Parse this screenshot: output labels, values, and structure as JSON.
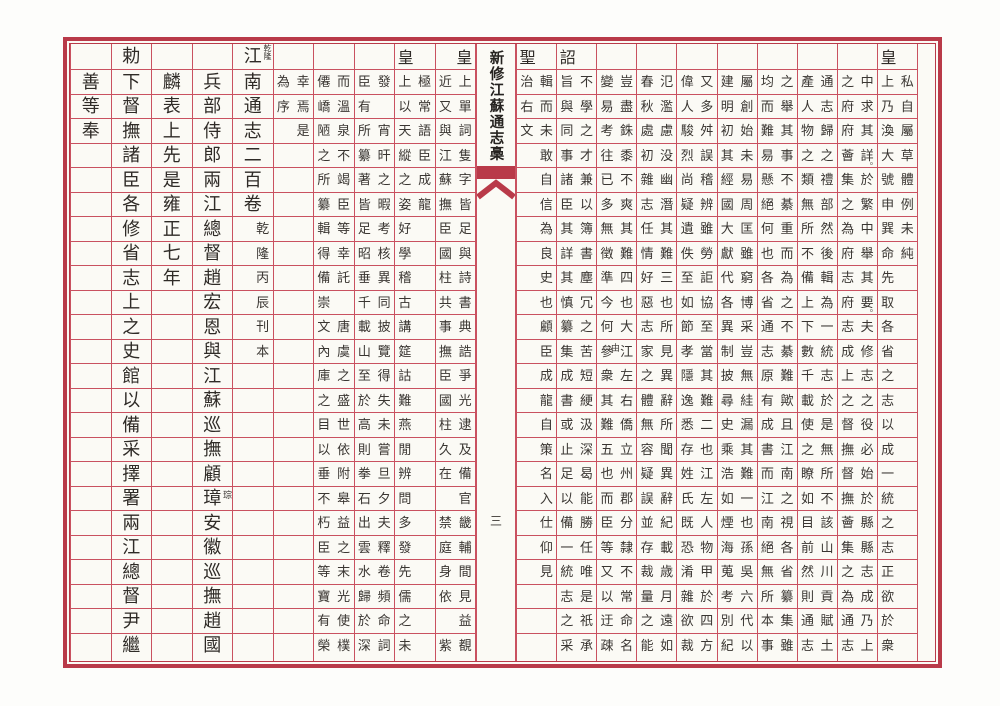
{
  "document": {
    "center_title": "新修江蘇通志槀",
    "page_number": "三",
    "colors": {
      "frame_red": "#b93a49",
      "grid_red": "#c95160",
      "ink": "#2f2b27",
      "paper": "#fbfaf5"
    },
    "grid_rows": 24
  },
  "left_page": {
    "columns": [
      {
        "raised": "皇",
        "raised_side": "right",
        "right": "上單詞隻字皆足與詩書典誥爭光逮及備官畿輔間見益覩",
        "left": "近又與江蘇撫臣國柱共事撫臣國柱久在 禁庭身依 紫"
      },
      {
        "raised": "皇",
        "raised_side": "left",
        "right": "極常語臣成龍",
        "left": "上以天縱之姿好學稽古講筵詁難燕閒辨問多發先儒之未"
      },
      {
        "right": "發 宵旰之暇考核異同披覽得失未嘗旦夕夫釋卷頻命詞",
        "left": "臣有所纂著皆足昭垂千載山至於高則拳石出雲水歸於深"
      },
      {
        "right": "而溫泉不竭臣等幸託 唐虞之盛世依附皋益之末光使樸",
        "left": "僊嶠陋之所纂輯得備崇文內庫之目以垂不朽臣等寶有榮"
      },
      {
        "right": "幸焉是",
        "left": "為序"
      },
      {
        "raised": "江",
        "raised_side": "center",
        "band_ann": "乾隆",
        "big": "南通志二百卷",
        "right": "      乾隆丙辰刊本"
      },
      {
        "big": "兵部侍郎兩江總督趙宏恩與江蘇巡撫顧璋安徽巡撫趙國",
        "ann": [
          {
            "r": 17,
            "side": "right",
            "text": "琮"
          }
        ]
      },
      {
        "big": "麟表上先是雍正七年"
      },
      {
        "raised": "勅",
        "raised_side": "center",
        "big": "下督撫諸臣各修省志上之史館以備采擇署兩江總督尹繼"
      },
      {
        "big": "善等奉"
      }
    ]
  },
  "right_page": {
    "columns": [
      {
        "raised": "皇",
        "raised_side": "left",
        "right": "私自屬草體例未純",
        "left": "上乃渙大號申巽命先取各省之志以成一統之志正欲於衆"
      },
      {
        "right": "中求其詳於繁中舉其要夫修志之役必始於縣縣志成乃上",
        "left": "之府府薈集之為府志府志成上之督撫督撫薈集之為通志",
        "ann": [
          {
            "r": 3,
            "side": "dot",
            "text": "。"
          },
          {
            "r": 9,
            "side": "dot",
            "text": "。"
          }
        ]
      },
      {
        "right": "通志歸之禮部然後輯為一統志於是無所不該山川貢賦土",
        "left": "產人物之類無所不備上下數千載使之瞭如目前然則通志"
      },
      {
        "right": "之舉其事不綦重而為之不綦難歟且江南之視各省纂集雖",
        "left": "均而難易懸絕何也各省通志原有成書而江南絕無所本事"
      },
      {
        "right": "屬創始未易周匡雖窮博采豈無絓漏其難一也孫吳六代以",
        "left": "建明初其經國大獻代各異制披尋史乘浩如煙海蒐考別紀"
      },
      {
        "right": "又多舛誤稽辨雖勞詎協至當其難二也江左人物甲於四方",
        "left": "偉人駿烈尚疑遺佚至如節孝隱逸悉存姓氏既恐淆雜欲裁"
      },
      {
        "right": "氾濫慮没幽潛其難三也所見異辭所聞異辭紀載歳月遠如",
        "left": "春秋處初雜志任情好惡志家之體無容疑誤並存裁量之能"
      },
      {
        "right": "豈盡銖黍不爽其難四也大江左右僑立州郡分隸不常命名",
        "left": "變易考往已多無徵準今何參衆其難五也而臣等又以迂疎",
        "ann": [
          {
            "r": 11,
            "side": "mid",
            "text": "由"
          }
        ]
      },
      {
        "raised": "詔",
        "raised_side": "left",
        "right": "不學之才兼以簿書塵冗之苦短綆汲深曷能勝任唯是祇承",
        "left": "旨與同事諸臣其詳其慎纂集成書或止足以備一統志之采"
      },
      {
        "raised": "聖",
        "raised_side": "left",
        "right": "輯而未敢自信為良史也顧臣成龍自策名入仕仰見",
        "left": "治右文"
      }
    ]
  }
}
